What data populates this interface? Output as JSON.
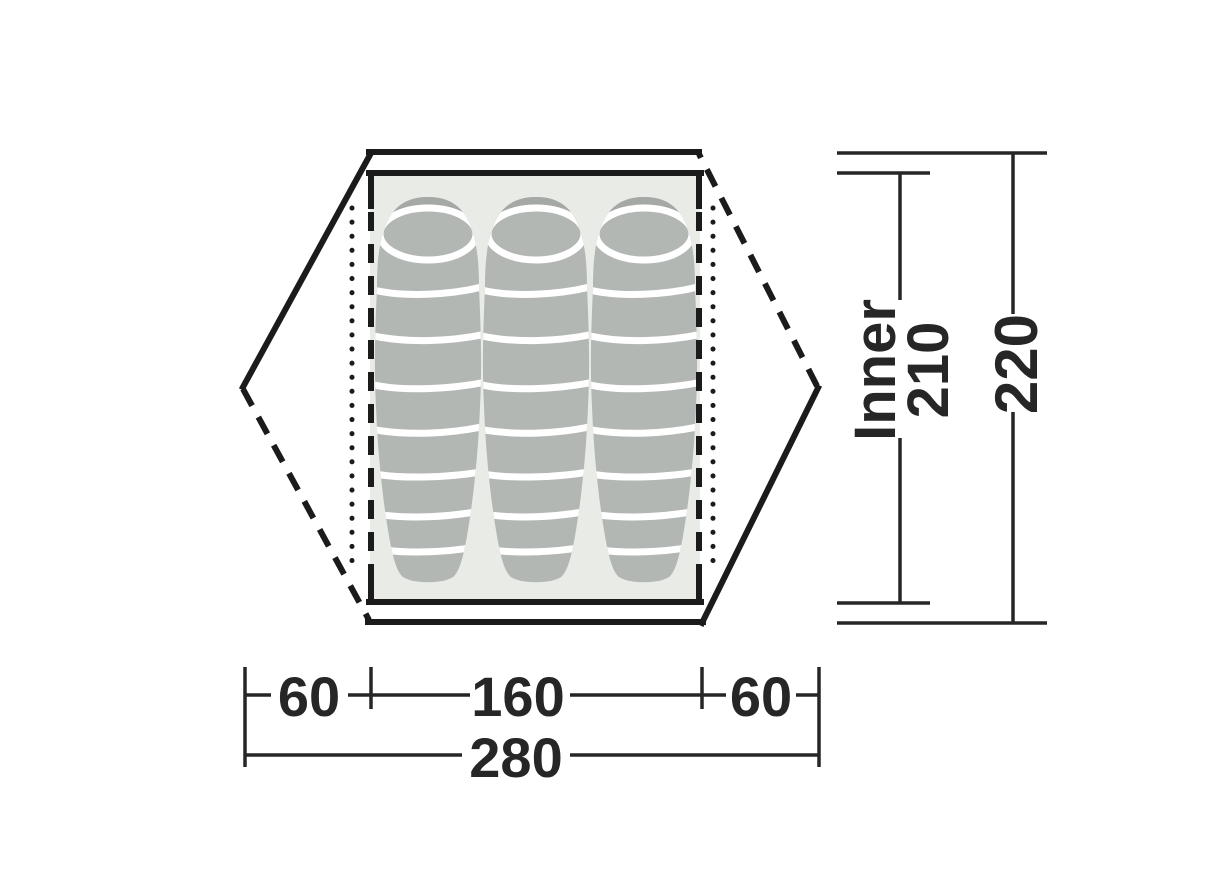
{
  "diagram": {
    "kind": "tent-floorplan-top-view",
    "sleeping_bag_count": 3
  },
  "dimensions": {
    "inner_length": {
      "label": "Inner",
      "value": "210"
    },
    "outer_length": {
      "value": "220"
    },
    "left_offset_width": {
      "value": "60"
    },
    "inner_width": {
      "value": "160"
    },
    "right_offset_width": {
      "value": "60"
    },
    "outer_width": {
      "value": "280"
    }
  },
  "colors": {
    "outline": "#1b1b1b",
    "dimension": "#262626",
    "floor": "#e9ebe7",
    "bag": "#b3b7b3",
    "bag_shadow": "#a5a9a5",
    "band": "#ffffff"
  }
}
